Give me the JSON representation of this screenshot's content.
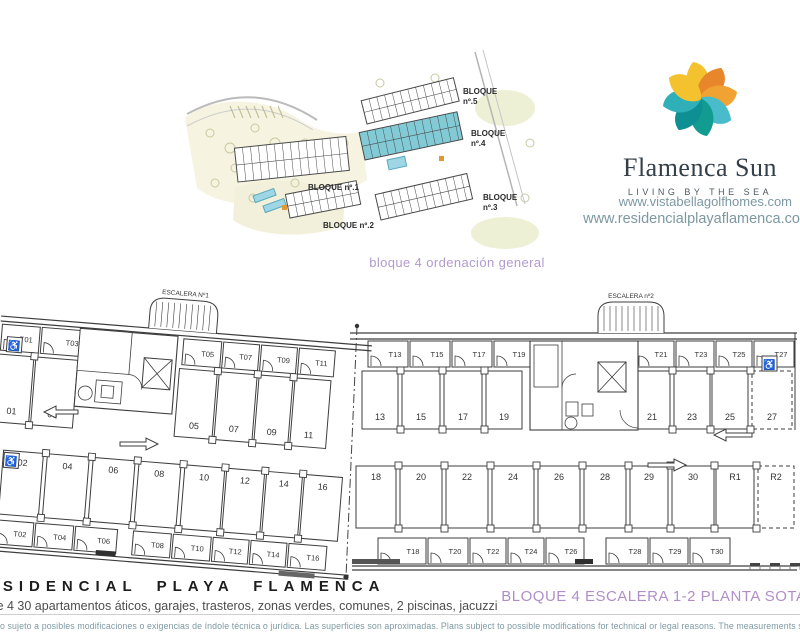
{
  "site_plan": {
    "caption": "bloque 4 ordenación general",
    "blocks": [
      {
        "line1": "BLOQUE",
        "line2": "nº.5"
      },
      {
        "line1": "BLOQUE",
        "line2": "nº.4"
      },
      {
        "line1": "BLOQUE",
        "line2": "nº.3"
      },
      {
        "line1": "BLOQUE nº.1",
        "line2": ""
      },
      {
        "line1": "BLOQUE nº.2",
        "line2": ""
      }
    ]
  },
  "brand": {
    "name": "Flamenca Sun",
    "tagline": "LIVING BY THE SEA",
    "website1": "www.vistabellagolfhomes.com",
    "website2": "www.residencialplayaflamenca.com"
  },
  "floor_plan": {
    "escalera1_label": "ESCALERA Nº1",
    "escalera2_label": "ESCALERA nº2",
    "accessible_icon": "♿",
    "top_left": {
      "trasteros": [
        "T01",
        "T03",
        "T05",
        "T07",
        "T09",
        "T11"
      ],
      "stalls": [
        "01",
        "03",
        "05",
        "07",
        "09",
        "11"
      ]
    },
    "top_right": {
      "trasteros": [
        "T13",
        "T15",
        "T17",
        "T19",
        "T21",
        "T23",
        "T25",
        "T27"
      ],
      "stalls": [
        "13",
        "15",
        "17",
        "19",
        "21",
        "23",
        "25",
        "27"
      ]
    },
    "bottom_left": {
      "trasteros": [
        "T02",
        "T04",
        "T06",
        "T08",
        "T10",
        "T12",
        "T14",
        "T16"
      ],
      "stalls": [
        "02",
        "04",
        "06",
        "08",
        "10",
        "12",
        "14",
        "16"
      ]
    },
    "bottom_right": {
      "trasteros": [
        "T18",
        "T20",
        "T22",
        "T24",
        "T26",
        "T28",
        "T29",
        "T30"
      ],
      "stalls": [
        "18",
        "20",
        "22",
        "24",
        "26",
        "28",
        "29",
        "30",
        "R1",
        "R2"
      ]
    }
  },
  "footer": {
    "title": "RESIDENCIAL PLAYA FLAMENCA",
    "subtitle": "bloque 4 30 apartamentos áticos, garajes, trasteros, zonas verdes, comunes, 2 piscinas, jacuzzi",
    "plan_label": "BLOQUE 4 ESCALERA 1-2 PLANTA SOTANO",
    "disclaimer": "Plano sujeto a posibles modificaciones o exigencias de índole técnica o jurídica. Las superficies son aproximadas. Plans subject to possible modifications for technical or legal reasons. The measurements shown are approximate."
  },
  "colors": {
    "accent_purple": "#B29BCE",
    "label_purple": "#B08FC8",
    "web_text": "#7C98A2",
    "plan_line": "#3d3d3d",
    "block4_teal": "#82CBD6",
    "logo_palette": [
      "#F4C22F",
      "#E8862B",
      "#F0A233",
      "#49BCCB",
      "#129B90",
      "#0D8F94",
      "#2FB0B8",
      "#F4C22F"
    ]
  }
}
